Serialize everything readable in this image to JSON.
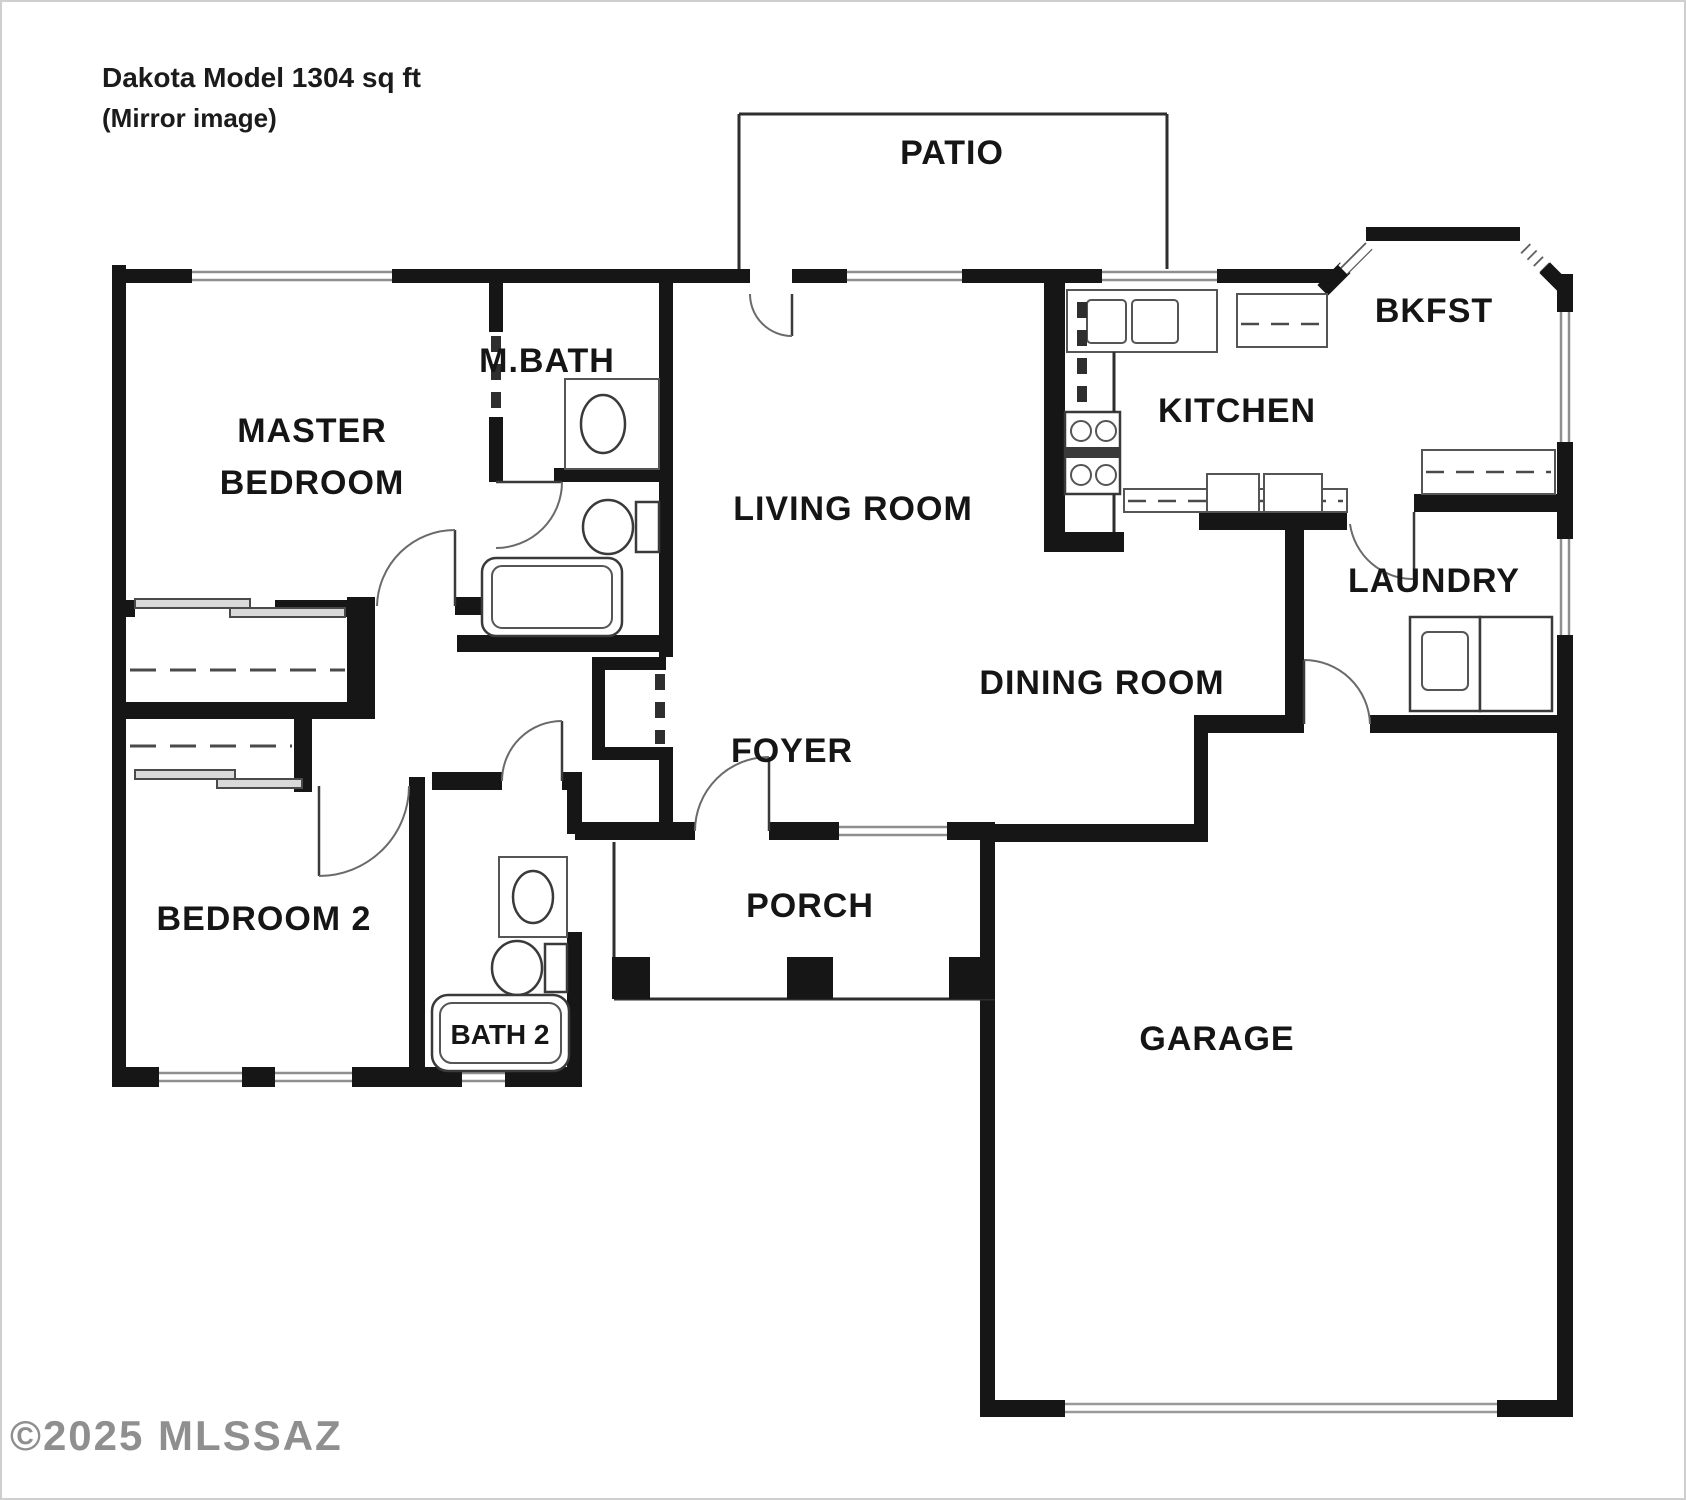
{
  "title": {
    "line1": "Dakota Model  1304 sq ft",
    "line2": "(Mirror image)"
  },
  "watermark": "©2025 MLSSAZ",
  "rooms": {
    "patio": "PATIO",
    "master_line1": "MASTER",
    "master_line2": "BEDROOM",
    "m_bath": "M.BATH",
    "living_room": "LIVING ROOM",
    "kitchen": "KITCHEN",
    "bkfst": "BKFST",
    "laundry": "LAUNDRY",
    "dining_room": "DINING ROOM",
    "foyer": "FOYER",
    "porch": "PORCH",
    "bedroom2": "BEDROOM 2",
    "bath2": "BATH 2",
    "garage": "GARAGE"
  },
  "colors": {
    "wall": "#161616",
    "thin_line": "#2e2e2e",
    "window_line": "#8f8f8f",
    "watermark_gray": "#7c7c7c"
  }
}
